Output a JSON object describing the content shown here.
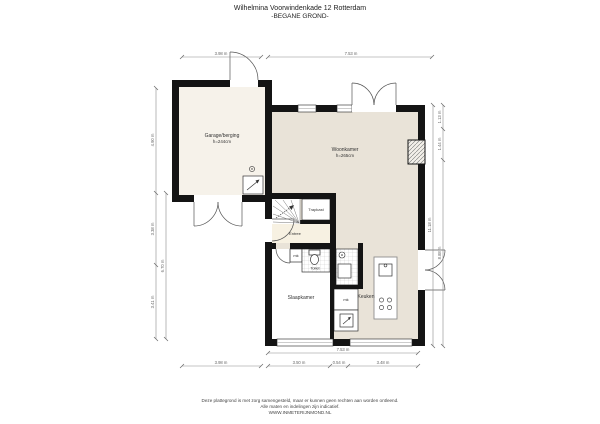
{
  "title": {
    "line1": "Wilhelmina Voorwindenkade 12 Rotterdam",
    "line2": "-BEGANE GROND-"
  },
  "rooms": {
    "garage": {
      "name": "Garage/berging",
      "height": "h=244cm"
    },
    "woonkamer": {
      "name": "Woonkamer",
      "height": "h=265cm"
    },
    "trapkast": {
      "name": "Trapkast"
    },
    "entree": {
      "name": "Entree"
    },
    "toilet": {
      "name": "Toilet"
    },
    "slaapkamer": {
      "name": "Slaapkamer"
    },
    "keuken": {
      "name": "Keuken"
    },
    "mk_hal": {
      "name": "mk"
    },
    "mk_keuken": {
      "name": "mk"
    }
  },
  "dimensions": {
    "top": [
      "3.98 m",
      "7.53 m"
    ],
    "bottom_total": "7.53 m",
    "bottom": [
      "3.98 m",
      "3.50 m",
      "0.54 m",
      "3.48 m"
    ],
    "left_outer": [
      "4.90 m",
      "3.38 m",
      "3.41 m"
    ],
    "left_inner": "6.70 m",
    "right_inner": "11.18 m",
    "right_outer": [
      "1.13 m",
      "1.44 m",
      "8.88 m"
    ]
  },
  "footer": {
    "line1": "Deze plattegrond is met zorg samengesteld, maar er kunnen geen rechten aan worden ontleend.",
    "line2": "Alle maten en indelingen zijn indicatief.",
    "line3": "WWW.INMETERIJNMOND.NL"
  },
  "colors": {
    "wall": "#141414",
    "garage_floor": "#f6f2ea",
    "main_floor": "#e9e3d8",
    "entree_floor": "#f7f1e2",
    "white_room": "#ffffff"
  }
}
